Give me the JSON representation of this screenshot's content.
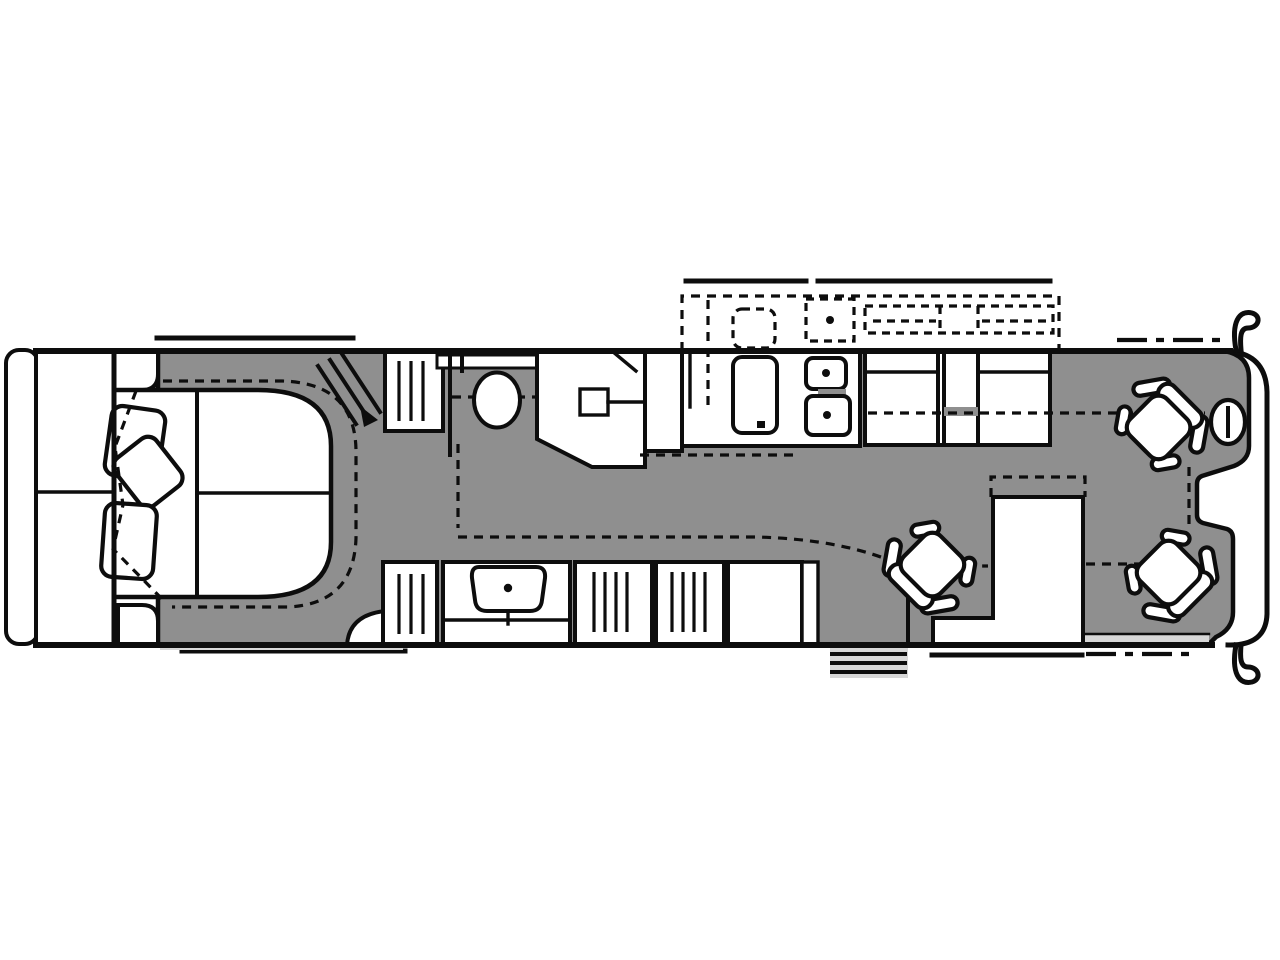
{
  "diagram": {
    "type": "rv-motorhome-floor-plan",
    "orientation": "rear-left-front-right",
    "colors": {
      "floor": "#8f8f8f",
      "line": "#0d0d0d",
      "light": "#d7d7d7",
      "white": "#ffffff",
      "background": "#ffffff"
    },
    "rooms": [
      {
        "name": "rear-bedroom"
      },
      {
        "name": "bathroom"
      },
      {
        "name": "galley-kitchen"
      },
      {
        "name": "living-area"
      },
      {
        "name": "cockpit"
      }
    ],
    "fixtures": [
      {
        "name": "rear-cap"
      },
      {
        "name": "rear-wardrobe"
      },
      {
        "name": "bed-with-pillows"
      },
      {
        "name": "nightstand-top"
      },
      {
        "name": "nightstand-bottom"
      },
      {
        "name": "bedroom-tv-hatch"
      },
      {
        "name": "wardrobe-louvered-door"
      },
      {
        "name": "bath-window"
      },
      {
        "name": "toilet"
      },
      {
        "name": "shower-with-head"
      },
      {
        "name": "linen-closet"
      },
      {
        "name": "refrigerator"
      },
      {
        "name": "double-kitchen-sink"
      },
      {
        "name": "kitchen-counter-stove-unit"
      },
      {
        "name": "kitchen-slide-dashed-outline"
      },
      {
        "name": "vanity-with-sink"
      },
      {
        "name": "louvered-cabinets"
      },
      {
        "name": "entry-steps"
      },
      {
        "name": "dinette-cabinet"
      },
      {
        "name": "lounge-chair"
      },
      {
        "name": "passenger-captain-chair"
      },
      {
        "name": "driver-captain-chair"
      },
      {
        "name": "steering-wheel"
      },
      {
        "name": "front-cap-with-mirrors"
      },
      {
        "name": "slide-out-topper-lines"
      },
      {
        "name": "slide-travel-dashed-lines"
      }
    ]
  }
}
